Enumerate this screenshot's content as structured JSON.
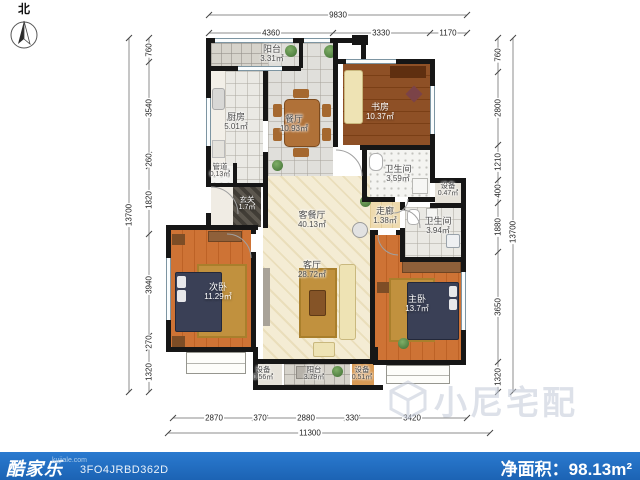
{
  "compass": {
    "label": "北"
  },
  "rooms": [
    {
      "name": "阳台",
      "area": "3.31㎡"
    },
    {
      "name": "厨房",
      "area": "5.01㎡"
    },
    {
      "name": "餐厅",
      "area": "10.93㎡"
    },
    {
      "name": "书房",
      "area": "10.37㎡"
    },
    {
      "name": "管道",
      "area": "0.13㎡"
    },
    {
      "name": "玄关",
      "area": "1.7㎡"
    },
    {
      "name": "卫生间",
      "area": "3.59㎡"
    },
    {
      "name": "设备",
      "area": "0.47㎡"
    },
    {
      "name": "走廊",
      "area": "1.38㎡"
    },
    {
      "name": "卫生间",
      "area": "3.94㎡"
    },
    {
      "name": "客餐厅",
      "area": "40.13㎡"
    },
    {
      "name": "客厅",
      "area": "28.72㎡"
    },
    {
      "name": "次卧",
      "area": "11.29㎡"
    },
    {
      "name": "主卧",
      "area": "13.7㎡"
    },
    {
      "name": "设备",
      "area": "0.56㎡"
    },
    {
      "name": "阳台",
      "area": "3.79㎡"
    },
    {
      "name": "设备",
      "area": "0.51㎡"
    }
  ],
  "dims": {
    "top": {
      "overall": "9830",
      "segments": [
        "4360",
        "3330",
        "1170"
      ]
    },
    "left": {
      "overall": "13700",
      "segments": [
        "760",
        "3540",
        "260",
        "1820",
        "3940",
        "270",
        "1320"
      ]
    },
    "right": {
      "overall": "13700",
      "segments": [
        "760",
        "2800",
        "1210",
        "400",
        "1880",
        "3650",
        "1320"
      ]
    },
    "bottom": {
      "overall": "11300",
      "segments": [
        "2870",
        "370",
        "2880",
        "330",
        "3420"
      ]
    }
  },
  "watermark": {
    "text": "小尼宅配"
  },
  "footer": {
    "brand": "酷家乐",
    "brand_site": "kujiale.com",
    "plan_id": "3FO4JRBD362D",
    "net_area_label": "净面积：",
    "net_area_value": "98.13",
    "net_area_unit": "m²"
  },
  "colors": {
    "footer_bg": "#2171c3",
    "wall": "#161616",
    "accent_wood": "#ce7335"
  }
}
